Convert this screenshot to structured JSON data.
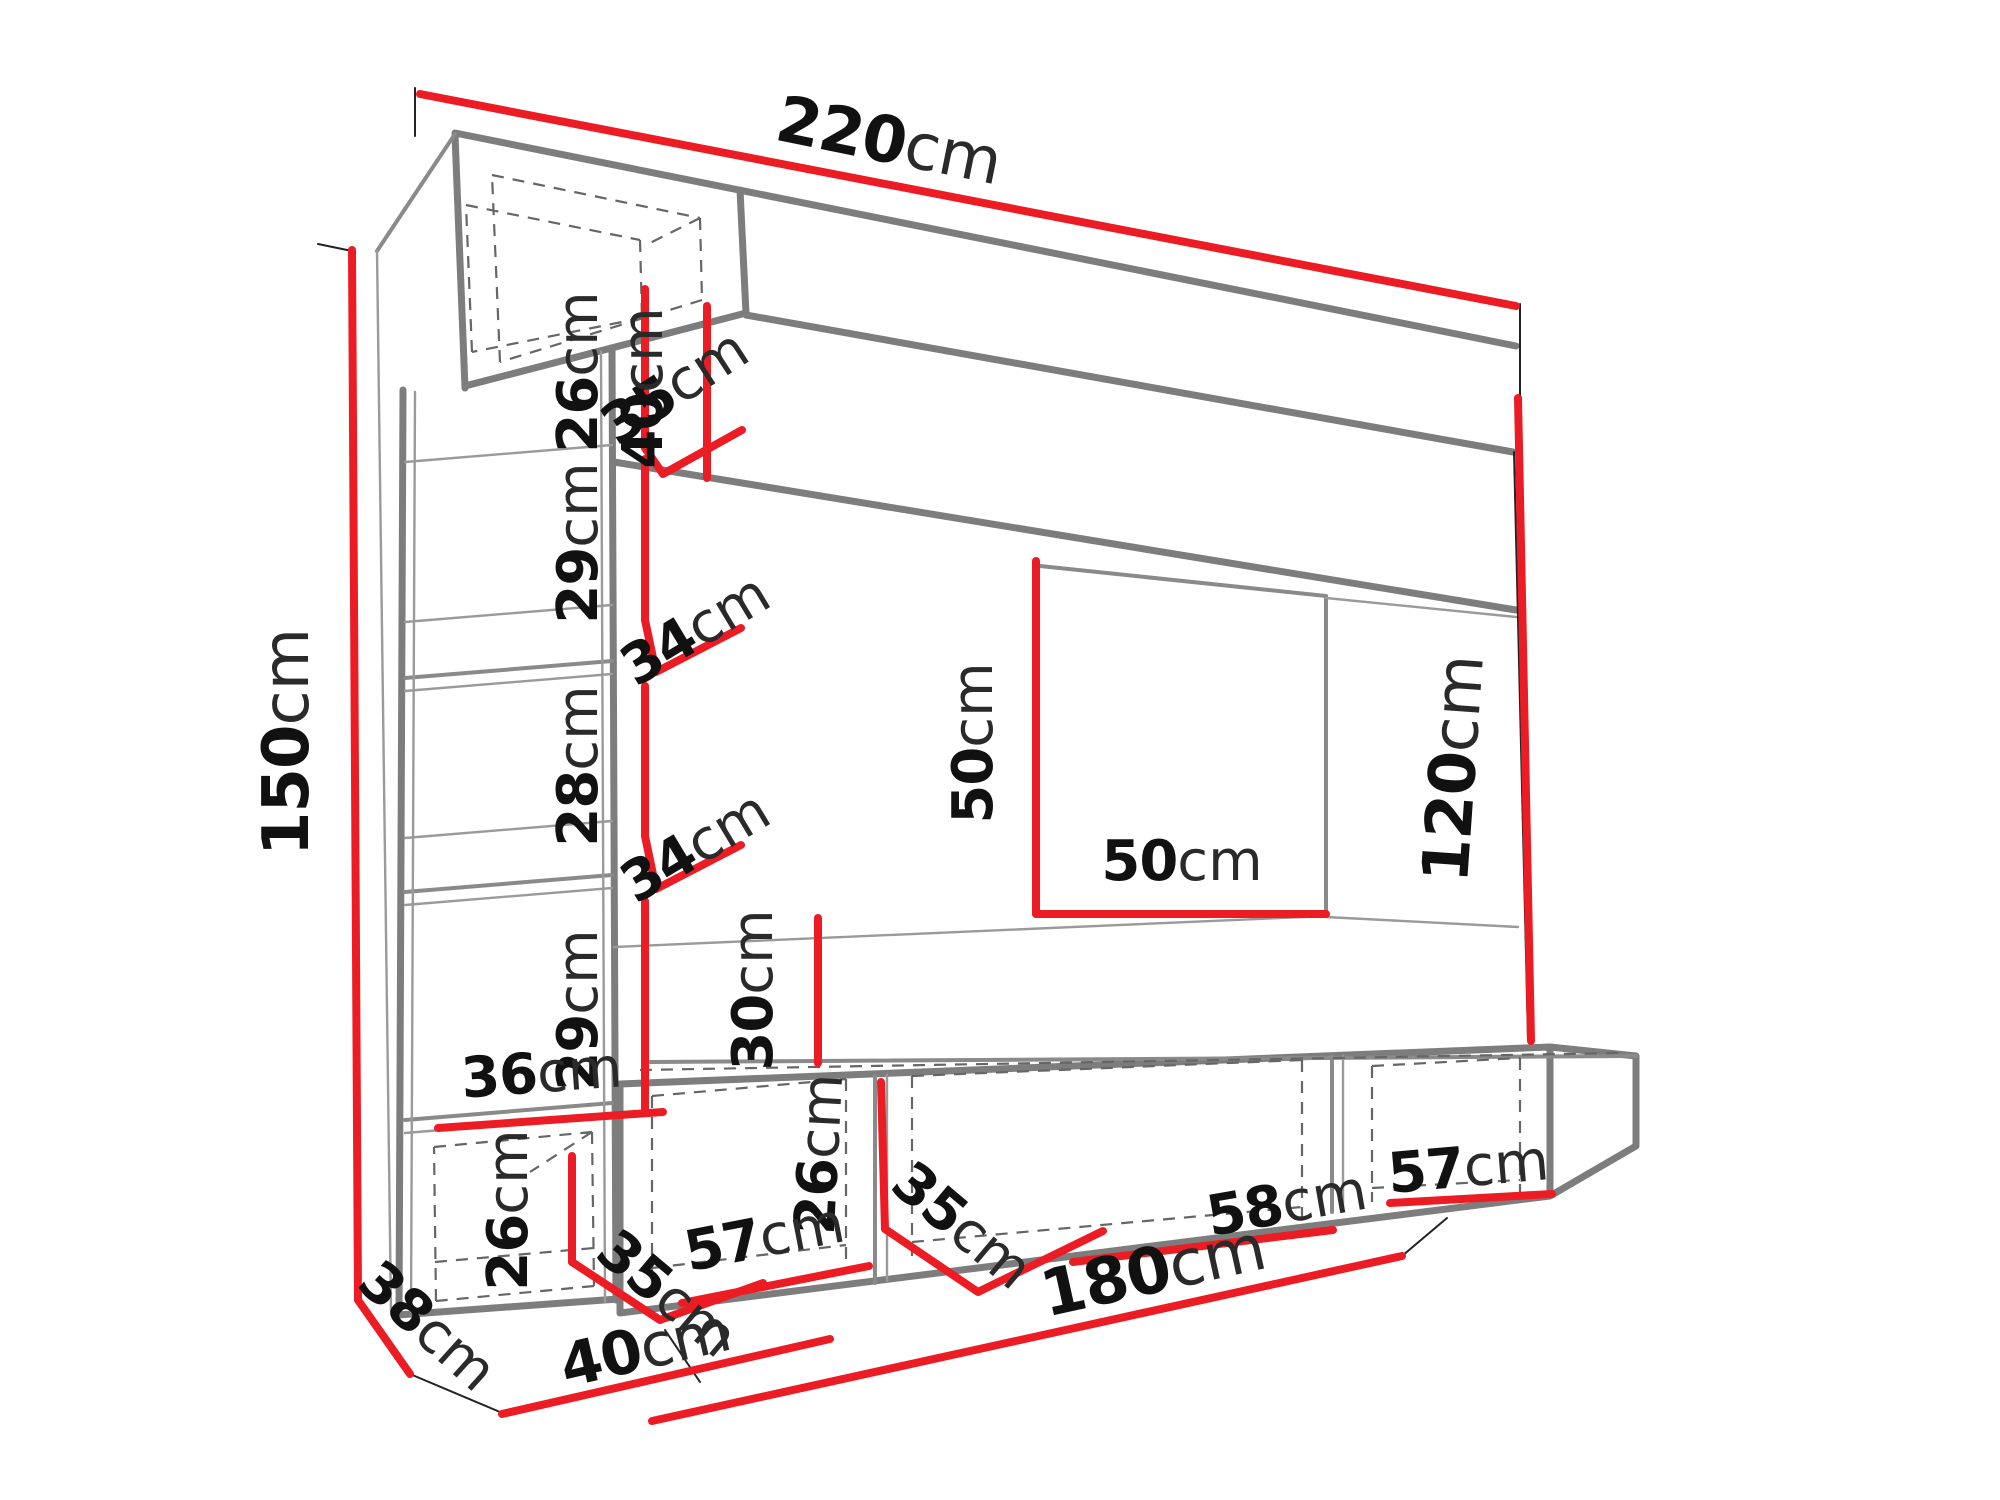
{
  "figure": {
    "kind": "furniture-wall-unit-dimension-diagram",
    "unit_of_measure": "cm",
    "background": "#ffffff",
    "colors": {
      "dimension_line": "#ec1c24",
      "structure": "#7d7d7d",
      "hidden_edge": "#666666",
      "text": "#111111"
    }
  },
  "dimensions": {
    "total_width": {
      "value": "220",
      "unit": "cm"
    },
    "total_height": {
      "value": "150",
      "unit": "cm"
    },
    "top_cabinet_height": {
      "value": "26",
      "unit": "cm"
    },
    "top_cabinet_depth": {
      "value": "35",
      "unit": "cm"
    },
    "shelf_gap_1": {
      "value": "29",
      "unit": "cm"
    },
    "shelf_depth_1": {
      "value": "34",
      "unit": "cm"
    },
    "shelf_gap_2": {
      "value": "28",
      "unit": "cm"
    },
    "shelf_depth_2": {
      "value": "34",
      "unit": "cm"
    },
    "shelf_gap_3": {
      "value": "29",
      "unit": "cm"
    },
    "base_inner_width": {
      "value": "36",
      "unit": "cm"
    },
    "base_cab_height": {
      "value": "26",
      "unit": "cm"
    },
    "base_cab_depth": {
      "value": "35",
      "unit": "cm"
    },
    "column_depth": {
      "value": "38",
      "unit": "cm"
    },
    "column_width": {
      "value": "40",
      "unit": "cm"
    },
    "top_panel_height": {
      "value": "40",
      "unit": "cm"
    },
    "recess_height": {
      "value": "50",
      "unit": "cm"
    },
    "recess_width": {
      "value": "50",
      "unit": "cm"
    },
    "panel_gap": {
      "value": "30",
      "unit": "cm"
    },
    "right_height": {
      "value": "120",
      "unit": "cm"
    },
    "bench_height": {
      "value": "26",
      "unit": "cm"
    },
    "bench_depth": {
      "value": "35",
      "unit": "cm"
    },
    "bench_comp_left": {
      "value": "57",
      "unit": "cm"
    },
    "bench_comp_mid": {
      "value": "58",
      "unit": "cm"
    },
    "bench_comp_right": {
      "value": "57",
      "unit": "cm"
    },
    "bench_total_width": {
      "value": "180",
      "unit": "cm"
    }
  }
}
